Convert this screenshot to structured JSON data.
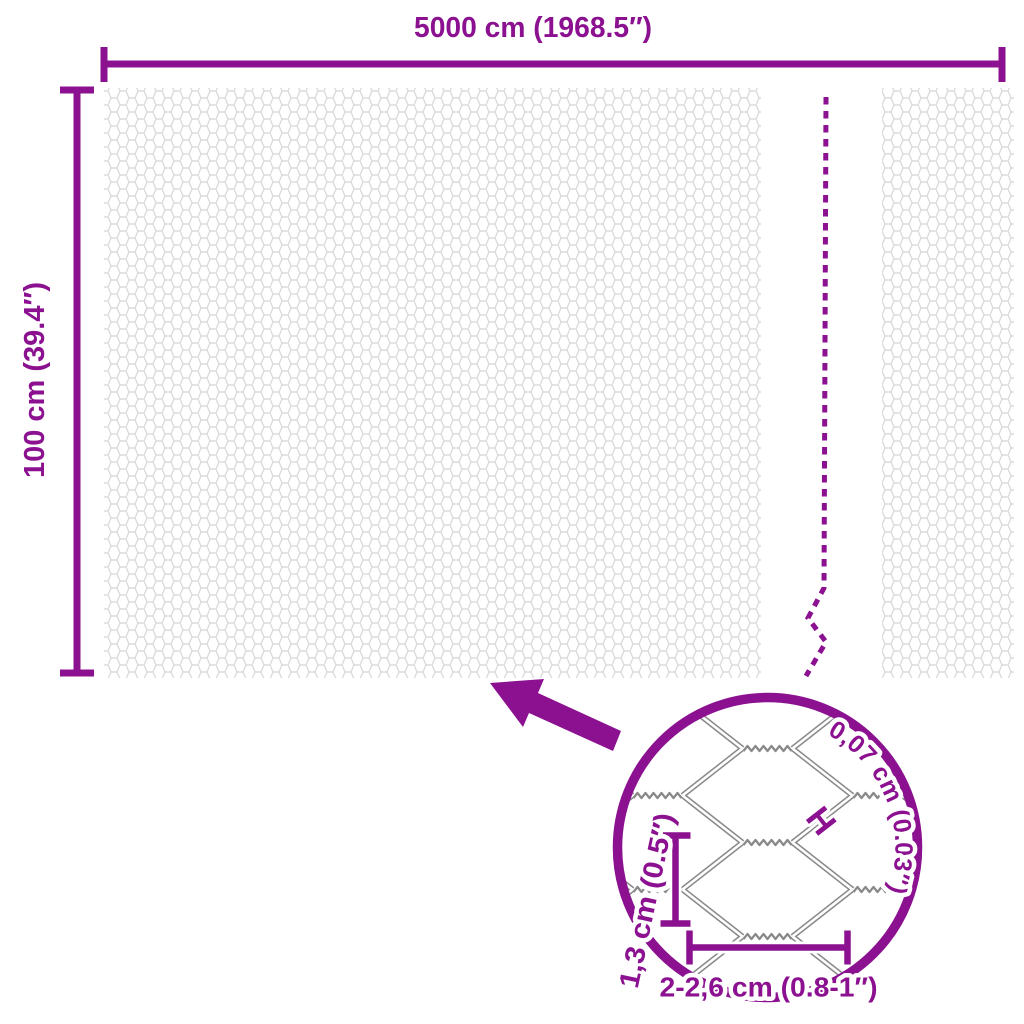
{
  "colors": {
    "accent": "#8B1190",
    "mesh_pattern": "#DBDBDB",
    "wire": "#8A8A8A"
  },
  "diagram": {
    "roll_width_label": "5000 cm (1968.5″)",
    "roll_height_label": "100 cm (39.4″)",
    "detail": {
      "wire_thickness_label": "0,07 cm (0.03″)",
      "wire_thickness_marker": "H",
      "mesh_height_label": "1,3 cm (0.5″)",
      "mesh_width_label": "2-2,6 cm (0.8-1″)"
    }
  }
}
